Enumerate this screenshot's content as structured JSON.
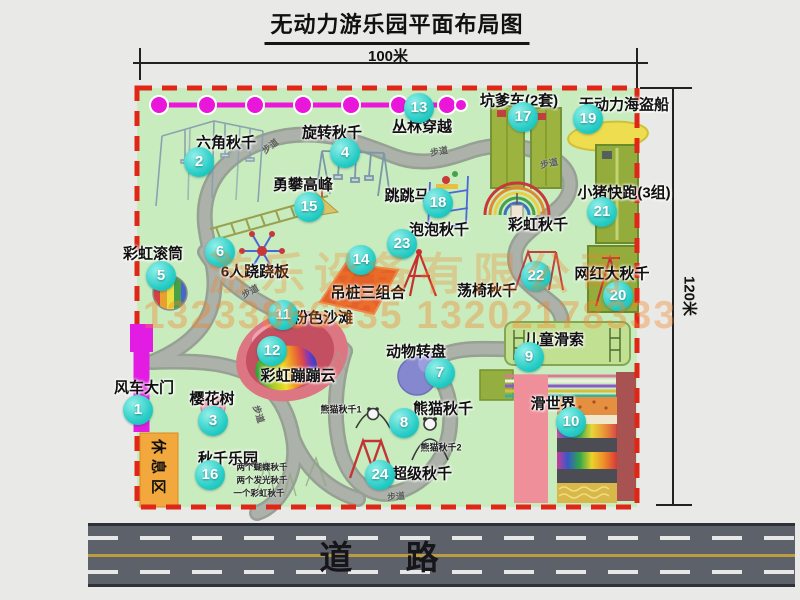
{
  "title": "无动力游乐园平面布局图",
  "dimensions": {
    "width_label": "100米",
    "height_label": "120米"
  },
  "road": {
    "label": "道 路"
  },
  "rest_area": {
    "label": "休息区"
  },
  "watermark": {
    "company": "游乐设备有限公司",
    "phone": "13233866535 13202178333"
  },
  "path_label_text": "步道",
  "path_markers": [
    {
      "x": 270,
      "y": 146,
      "rot": -38
    },
    {
      "x": 439,
      "y": 151,
      "rot": -10
    },
    {
      "x": 549,
      "y": 163,
      "rot": -12
    },
    {
      "x": 250,
      "y": 291,
      "rot": -28
    },
    {
      "x": 259,
      "y": 414,
      "rot": 72
    },
    {
      "x": 396,
      "y": 496,
      "rot": -5
    }
  ],
  "attractions": [
    {
      "num": "1",
      "label": "风车大门",
      "badge": [
        138,
        410
      ],
      "lab": [
        144,
        387
      ]
    },
    {
      "num": "2",
      "label": "六角秋千",
      "badge": [
        199,
        162
      ],
      "lab": [
        226,
        142
      ]
    },
    {
      "num": "3",
      "label": "樱花树",
      "badge": [
        213,
        421
      ],
      "lab": [
        212,
        398
      ]
    },
    {
      "num": "4",
      "label": "旋转秋千",
      "badge": [
        345,
        153
      ],
      "lab": [
        332,
        132
      ]
    },
    {
      "num": "5",
      "label": "彩虹滚筒",
      "badge": [
        161,
        276
      ],
      "lab": [
        153,
        253
      ]
    },
    {
      "num": "6",
      "label": "6人跷跷板",
      "badge": [
        220,
        252
      ],
      "lab": [
        255,
        271
      ]
    },
    {
      "num": "7",
      "label": "动物转盘",
      "badge": [
        440,
        373
      ],
      "lab": [
        416,
        351
      ]
    },
    {
      "num": "8",
      "label": "熊猫秋千",
      "badge": [
        404,
        423
      ],
      "lab": [
        443,
        408
      ]
    },
    {
      "num": "9",
      "label": "儿童滑索",
      "badge": [
        529,
        357
      ],
      "lab": [
        554,
        339
      ]
    },
    {
      "num": "10",
      "label": "滑世界",
      "badge": [
        571,
        422
      ],
      "lab": [
        553,
        403
      ]
    },
    {
      "num": "11",
      "label": "粉色沙滩",
      "badge": [
        283,
        315
      ],
      "lab": [
        323,
        317
      ]
    },
    {
      "num": "12",
      "label": "彩虹蹦蹦云",
      "badge": [
        272,
        351
      ],
      "lab": [
        298,
        375
      ]
    },
    {
      "num": "13",
      "label": "丛林穿越",
      "badge": [
        419,
        108
      ],
      "lab": [
        422,
        126
      ]
    },
    {
      "num": "14",
      "label": "吊桩三组合",
      "badge": [
        361,
        260
      ],
      "lab": [
        368,
        292
      ]
    },
    {
      "num": "15",
      "label": "勇攀高峰",
      "badge": [
        309,
        207
      ],
      "lab": [
        303,
        184
      ]
    },
    {
      "num": "16",
      "label": "秋千乐园",
      "badge": [
        210,
        475
      ],
      "lab": [
        228,
        458
      ]
    },
    {
      "num": "17",
      "label": "坑爹车(2套)",
      "badge": [
        523,
        117
      ],
      "lab": [
        519,
        100
      ]
    },
    {
      "num": "18",
      "label": "跳跳马",
      "badge": [
        438,
        203
      ],
      "lab": [
        407,
        195
      ]
    },
    {
      "num": "19",
      "label": "无动力海盗船",
      "badge": [
        588,
        119
      ],
      "lab": [
        624,
        104
      ]
    },
    {
      "num": "20",
      "label": "网红大秋千",
      "badge": [
        618,
        296
      ],
      "lab": [
        612,
        273
      ]
    },
    {
      "num": "21",
      "label": "小猪快跑(3组)",
      "badge": [
        602,
        212
      ],
      "lab": [
        624,
        192
      ]
    },
    {
      "num": "22",
      "label": "荡椅秋千",
      "badge": [
        536,
        276
      ],
      "lab": [
        487,
        290
      ]
    },
    {
      "num": "23",
      "label": "泡泡秋千",
      "badge": [
        402,
        244
      ],
      "lab": [
        439,
        229
      ]
    },
    {
      "num": "24",
      "label": "超级秋千",
      "badge": [
        380,
        475
      ],
      "lab": [
        422,
        473
      ]
    }
  ],
  "extra_labels": [
    {
      "label": "彩虹秋千",
      "pos": [
        538,
        224
      ]
    }
  ],
  "small_labels": [
    {
      "label": "熊猫秋千1",
      "pos": [
        341,
        409
      ]
    },
    {
      "label": "熊猫秋千2",
      "pos": [
        441,
        447
      ]
    }
  ],
  "swing_notes": [
    {
      "text": "两个蝴蝶秋千",
      "pos": [
        262,
        467
      ]
    },
    {
      "text": "两个发光秋千",
      "pos": [
        262,
        480
      ]
    },
    {
      "text": "一个彩虹秋千",
      "pos": [
        259,
        493
      ]
    }
  ]
}
